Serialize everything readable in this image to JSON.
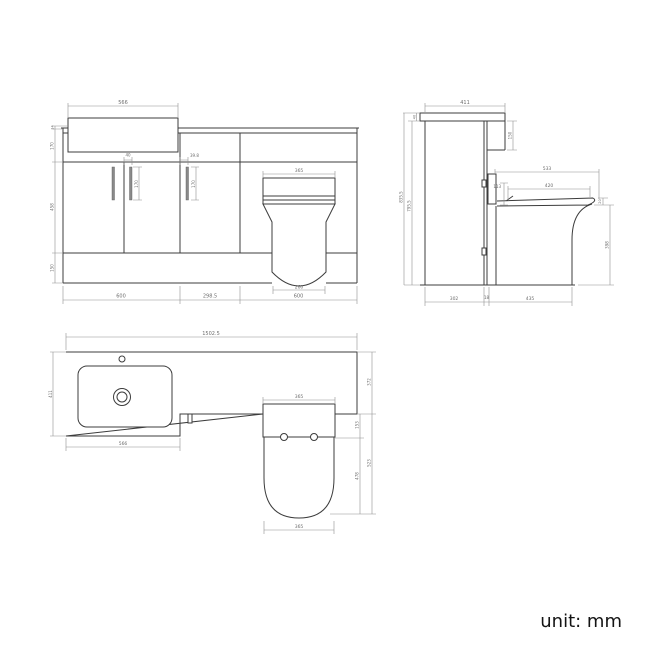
{
  "unit_label": "unit: mm",
  "front": {
    "basin_width": "566",
    "basin_rim": "14",
    "worktop_band_height": "170",
    "door_height": "458",
    "plinth_height": "150",
    "vanity_handle_offset": "40",
    "vanity_handle_length": "170",
    "wc_handle_offset": "39.8",
    "wc_handle_length": "170",
    "toilet_seat_width": "365",
    "toilet_base_width": "260",
    "vanity_unit_width": "600",
    "mid_unit_width": "298.5",
    "wc_unit_width": "600"
  },
  "side": {
    "worktop_depth": "411",
    "worktop_thickness": "40",
    "total_height": "835.5",
    "carcass_height": "795.5",
    "upstand_drop": "150",
    "seat_overall_depth": "533",
    "seat_depth": "420",
    "flush_recess_height": "113",
    "seat_thickness": "20",
    "pan_height": "398",
    "cabinet_depth": "302",
    "gap": "18",
    "pan_projection": "435"
  },
  "plan": {
    "total_width": "1502.5",
    "basin_unit_depth": "411",
    "basin_unit_width": "566",
    "seat_width": "365",
    "bowl_width": "365",
    "worktop_depth": "372",
    "seat_recess": "153",
    "pan_length": "523",
    "bowl_length": "478"
  }
}
